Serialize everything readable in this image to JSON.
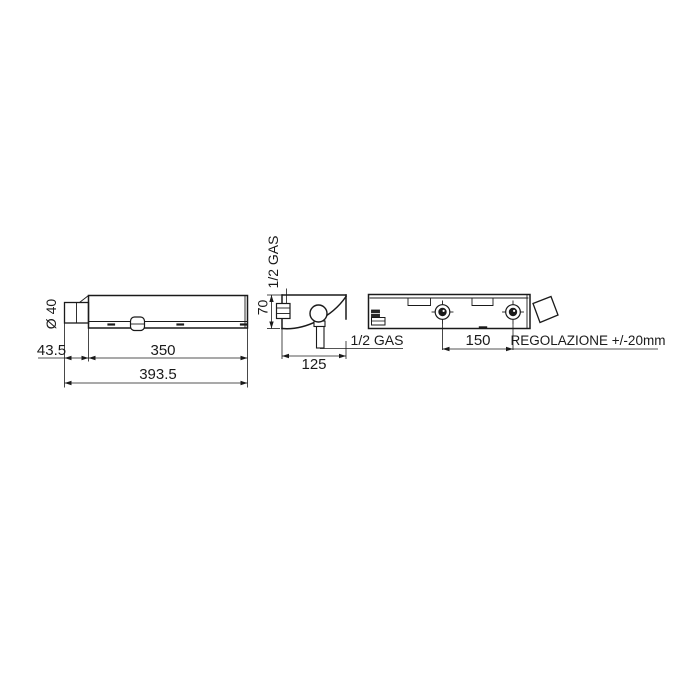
{
  "colors": {
    "background": "#ffffff",
    "line": "#1a1a1a"
  },
  "views": {
    "front": {
      "diameter": "Ø 40",
      "spout_length": "43.5",
      "body_length": "350",
      "total_length": "393.5"
    },
    "side": {
      "top_connection": "1/2 GAS",
      "height": "70",
      "depth": "125",
      "outlet_connection": "1/2 GAS"
    },
    "back": {
      "inlet_spacing": "150",
      "adjustment": "REGOLAZIONE +/-20mm"
    }
  }
}
